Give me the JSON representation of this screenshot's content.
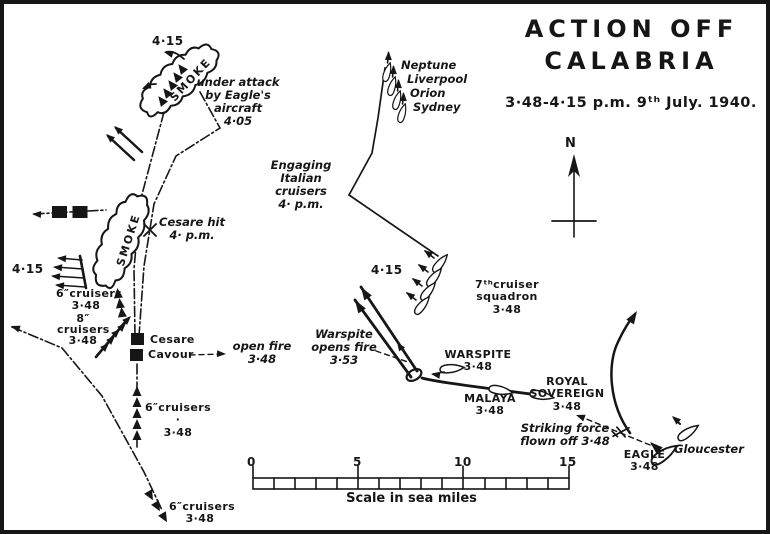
{
  "title": {
    "line1": "ACTION OFF",
    "line2": "CALABRIA",
    "subtitle": "3·48-4·15 p.m. 9ᵗʰ July. 1940."
  },
  "compass": {
    "north_label": "N"
  },
  "scale_bar": {
    "ticks": [
      "0",
      "5",
      "10",
      "15"
    ],
    "caption": "Scale in sea miles"
  },
  "labels": {
    "smoke_north": "SMOKE",
    "smoke_west": "SMOKE",
    "time_415_north": "4·15",
    "under_attack": "under attack\nby Eagle's aircraft\n4·05",
    "neptune": "Neptune",
    "liverpool": "Liverpool",
    "orion": "Orion",
    "sydney": "Sydney",
    "engaging": "Engaging\nItalian cruisers\n4· p.m.",
    "cesare_hit": "Cesare hit\n4· p.m.",
    "time_415_west": "4·15",
    "cruisers6_west": "6″cruisers\n3·48",
    "cruisers8": "8″\ncruisers\n3·48",
    "cesare": "Cesare",
    "cavour": "Cavour",
    "open_fire": "open fire\n3·48",
    "cruisers6_mid": "6″cruisers ·\n3·48",
    "cruisers6_south": "6″cruisers\n3·48",
    "time_415_fleet": "4·15",
    "seventh_cruiser_squadron": "7ᵗʰcruiser squadron\n3·48",
    "warspite_opens_fire": "Warspite\nopens fire\n3·53",
    "warspite": "WARSPITE\n3·48",
    "malaya": "MALAYA\n3·48",
    "royal_sovereign": "ROYAL SOVEREIGN\n3·48",
    "striking_force": "Striking force\nflown off 3·48",
    "eagle": "EAGLE\n3·48",
    "gloucester": "Gloucester"
  },
  "colors": {
    "ink": "#161616",
    "paper": "#ffffff"
  }
}
